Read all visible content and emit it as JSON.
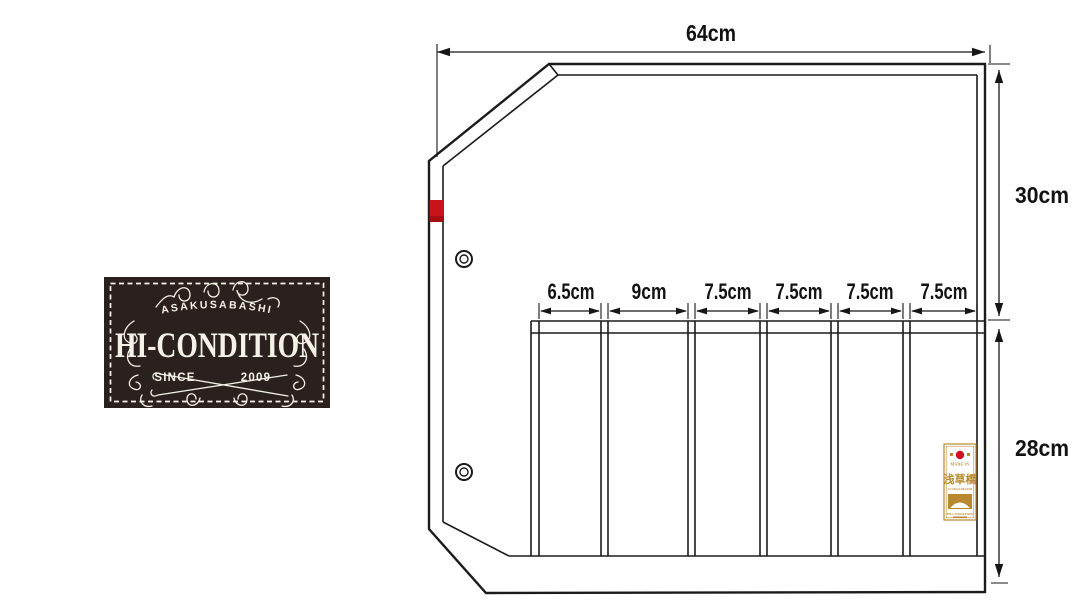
{
  "badge": {
    "location_text": "ASAKUSABASHI",
    "brand_text": "HI-CONDITION",
    "since_text": "SINCE",
    "year_text": "2009",
    "bg_color": "#2a211e",
    "text_color": "#f5f1e8"
  },
  "diagram": {
    "line_color": "#1b1b1b",
    "red_tab_color": "#c8141a",
    "width_dim": {
      "label": "64cm"
    },
    "upper_height_dim": {
      "label": "30cm"
    },
    "lower_height_dim": {
      "label": "28cm"
    },
    "pocket_dims": [
      {
        "label": "6.5cm"
      },
      {
        "label": "9cm"
      },
      {
        "label": "7.5cm"
      },
      {
        "label": "7.5cm"
      },
      {
        "label": "7.5cm"
      },
      {
        "label": "7.5cm"
      }
    ],
    "brand_tag": {
      "made_in_text": "MADE IN",
      "kanji_text": "浅草橋",
      "location_text": "ASAKUSABASHI",
      "brand_text": "HI-CONDITION",
      "gold_color": "#b8892f",
      "red_color": "#cf1126"
    }
  }
}
